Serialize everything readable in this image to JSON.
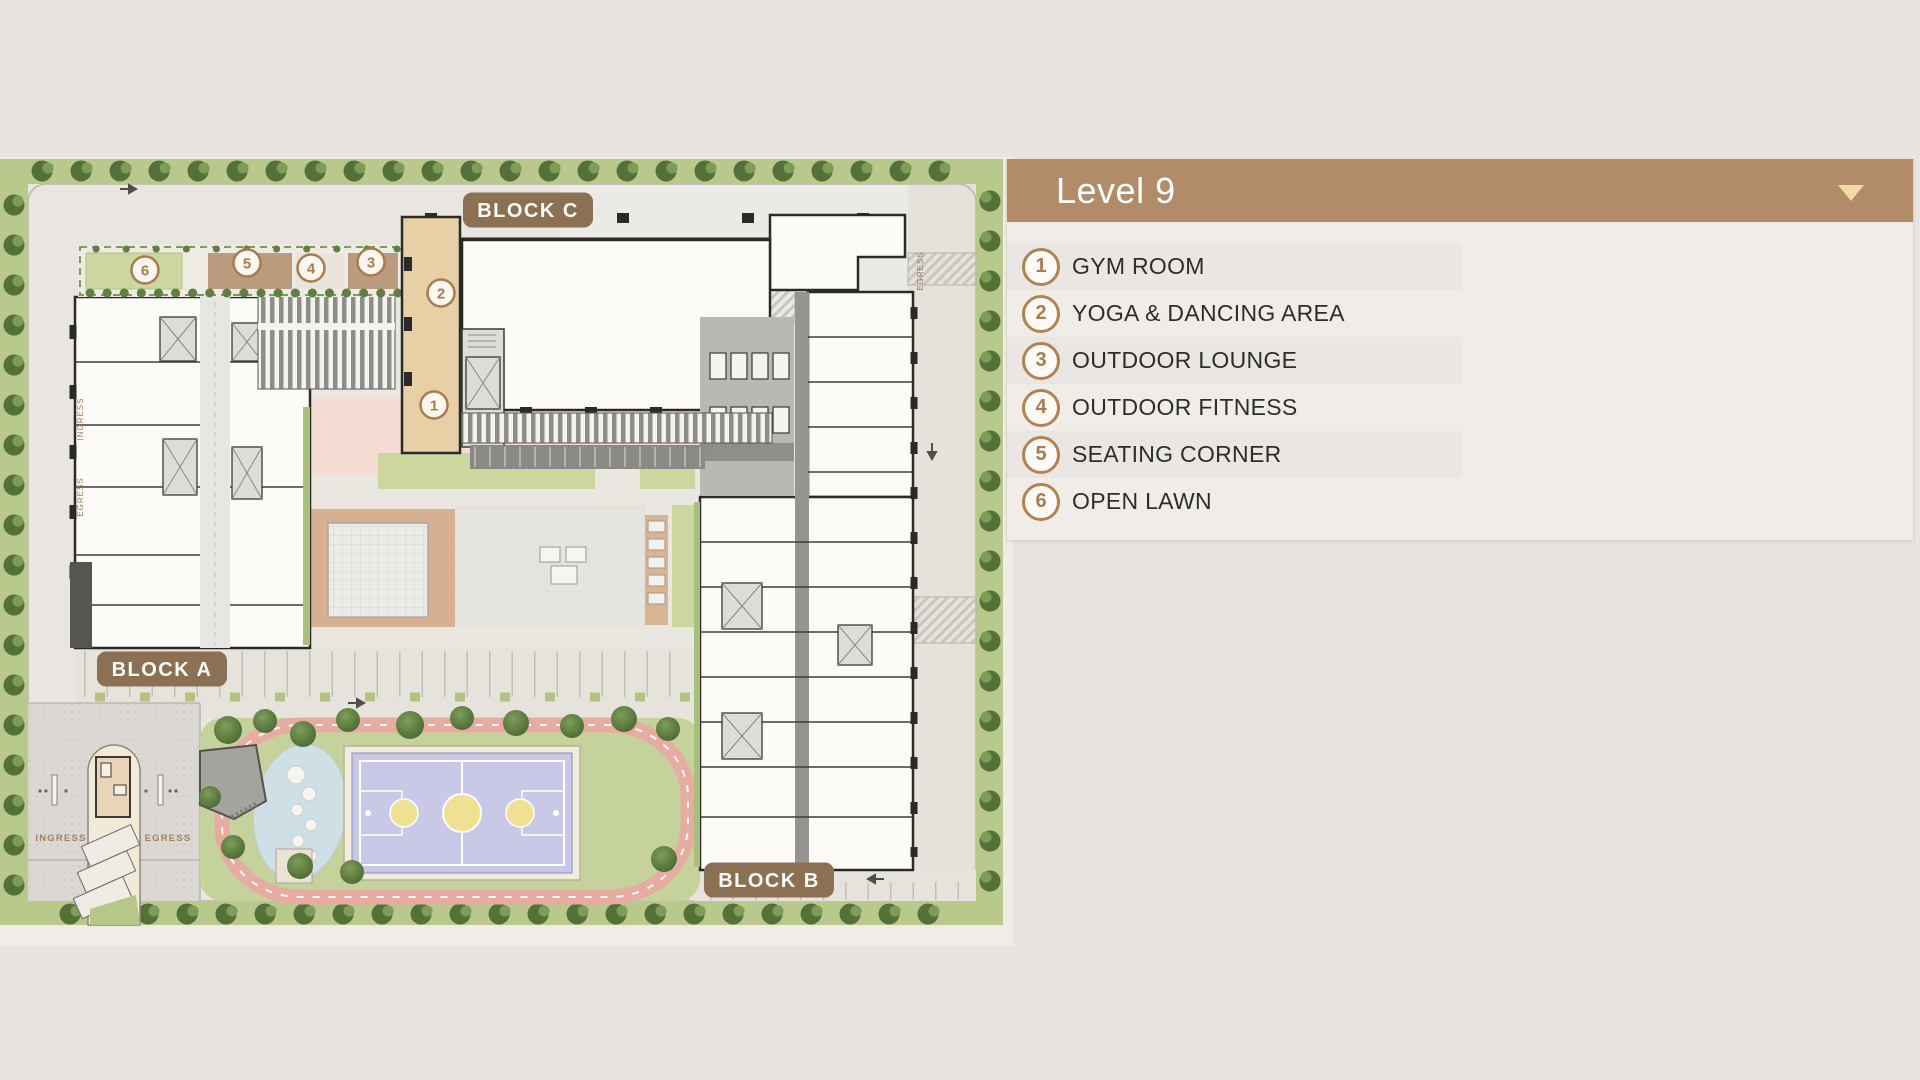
{
  "panel": {
    "title": "Level 9"
  },
  "legend": {
    "items": [
      {
        "number": "1",
        "label": "GYM ROOM"
      },
      {
        "number": "2",
        "label": "YOGA & DANCING AREA"
      },
      {
        "number": "3",
        "label": "OUTDOOR LOUNGE"
      },
      {
        "number": "4",
        "label": "OUTDOOR FITNESS"
      },
      {
        "number": "5",
        "label": "SEATING CORNER"
      },
      {
        "number": "6",
        "label": "OPEN LAWN"
      }
    ]
  },
  "plan": {
    "blocks": [
      {
        "label": "BLOCK C"
      },
      {
        "label": "BLOCK A"
      },
      {
        "label": "BLOCK B"
      }
    ],
    "markers": [
      {
        "number": "1"
      },
      {
        "number": "2"
      },
      {
        "number": "3"
      },
      {
        "number": "4"
      },
      {
        "number": "5"
      },
      {
        "number": "6"
      }
    ],
    "road_labels": {
      "ingress": "INGRESS",
      "egress": "EGRESS"
    }
  },
  "colors": {
    "page_bg": "#e7e4e1",
    "panel_bg": "#f0ede9",
    "row_bg": "#e9e6e3",
    "header_bg": "#b28c69",
    "arrow": "#f3dca4",
    "badge": "#8c7053",
    "marker": "#a87c4f",
    "lawn": "#c6d29b",
    "track": "#e7aca1",
    "court": "#c9c9e7",
    "court_accent": "#efe092",
    "splash": "#cfdfe6",
    "tree": "#54713a",
    "deck": "#bb9b7e",
    "tan": "#e8d0a6"
  }
}
